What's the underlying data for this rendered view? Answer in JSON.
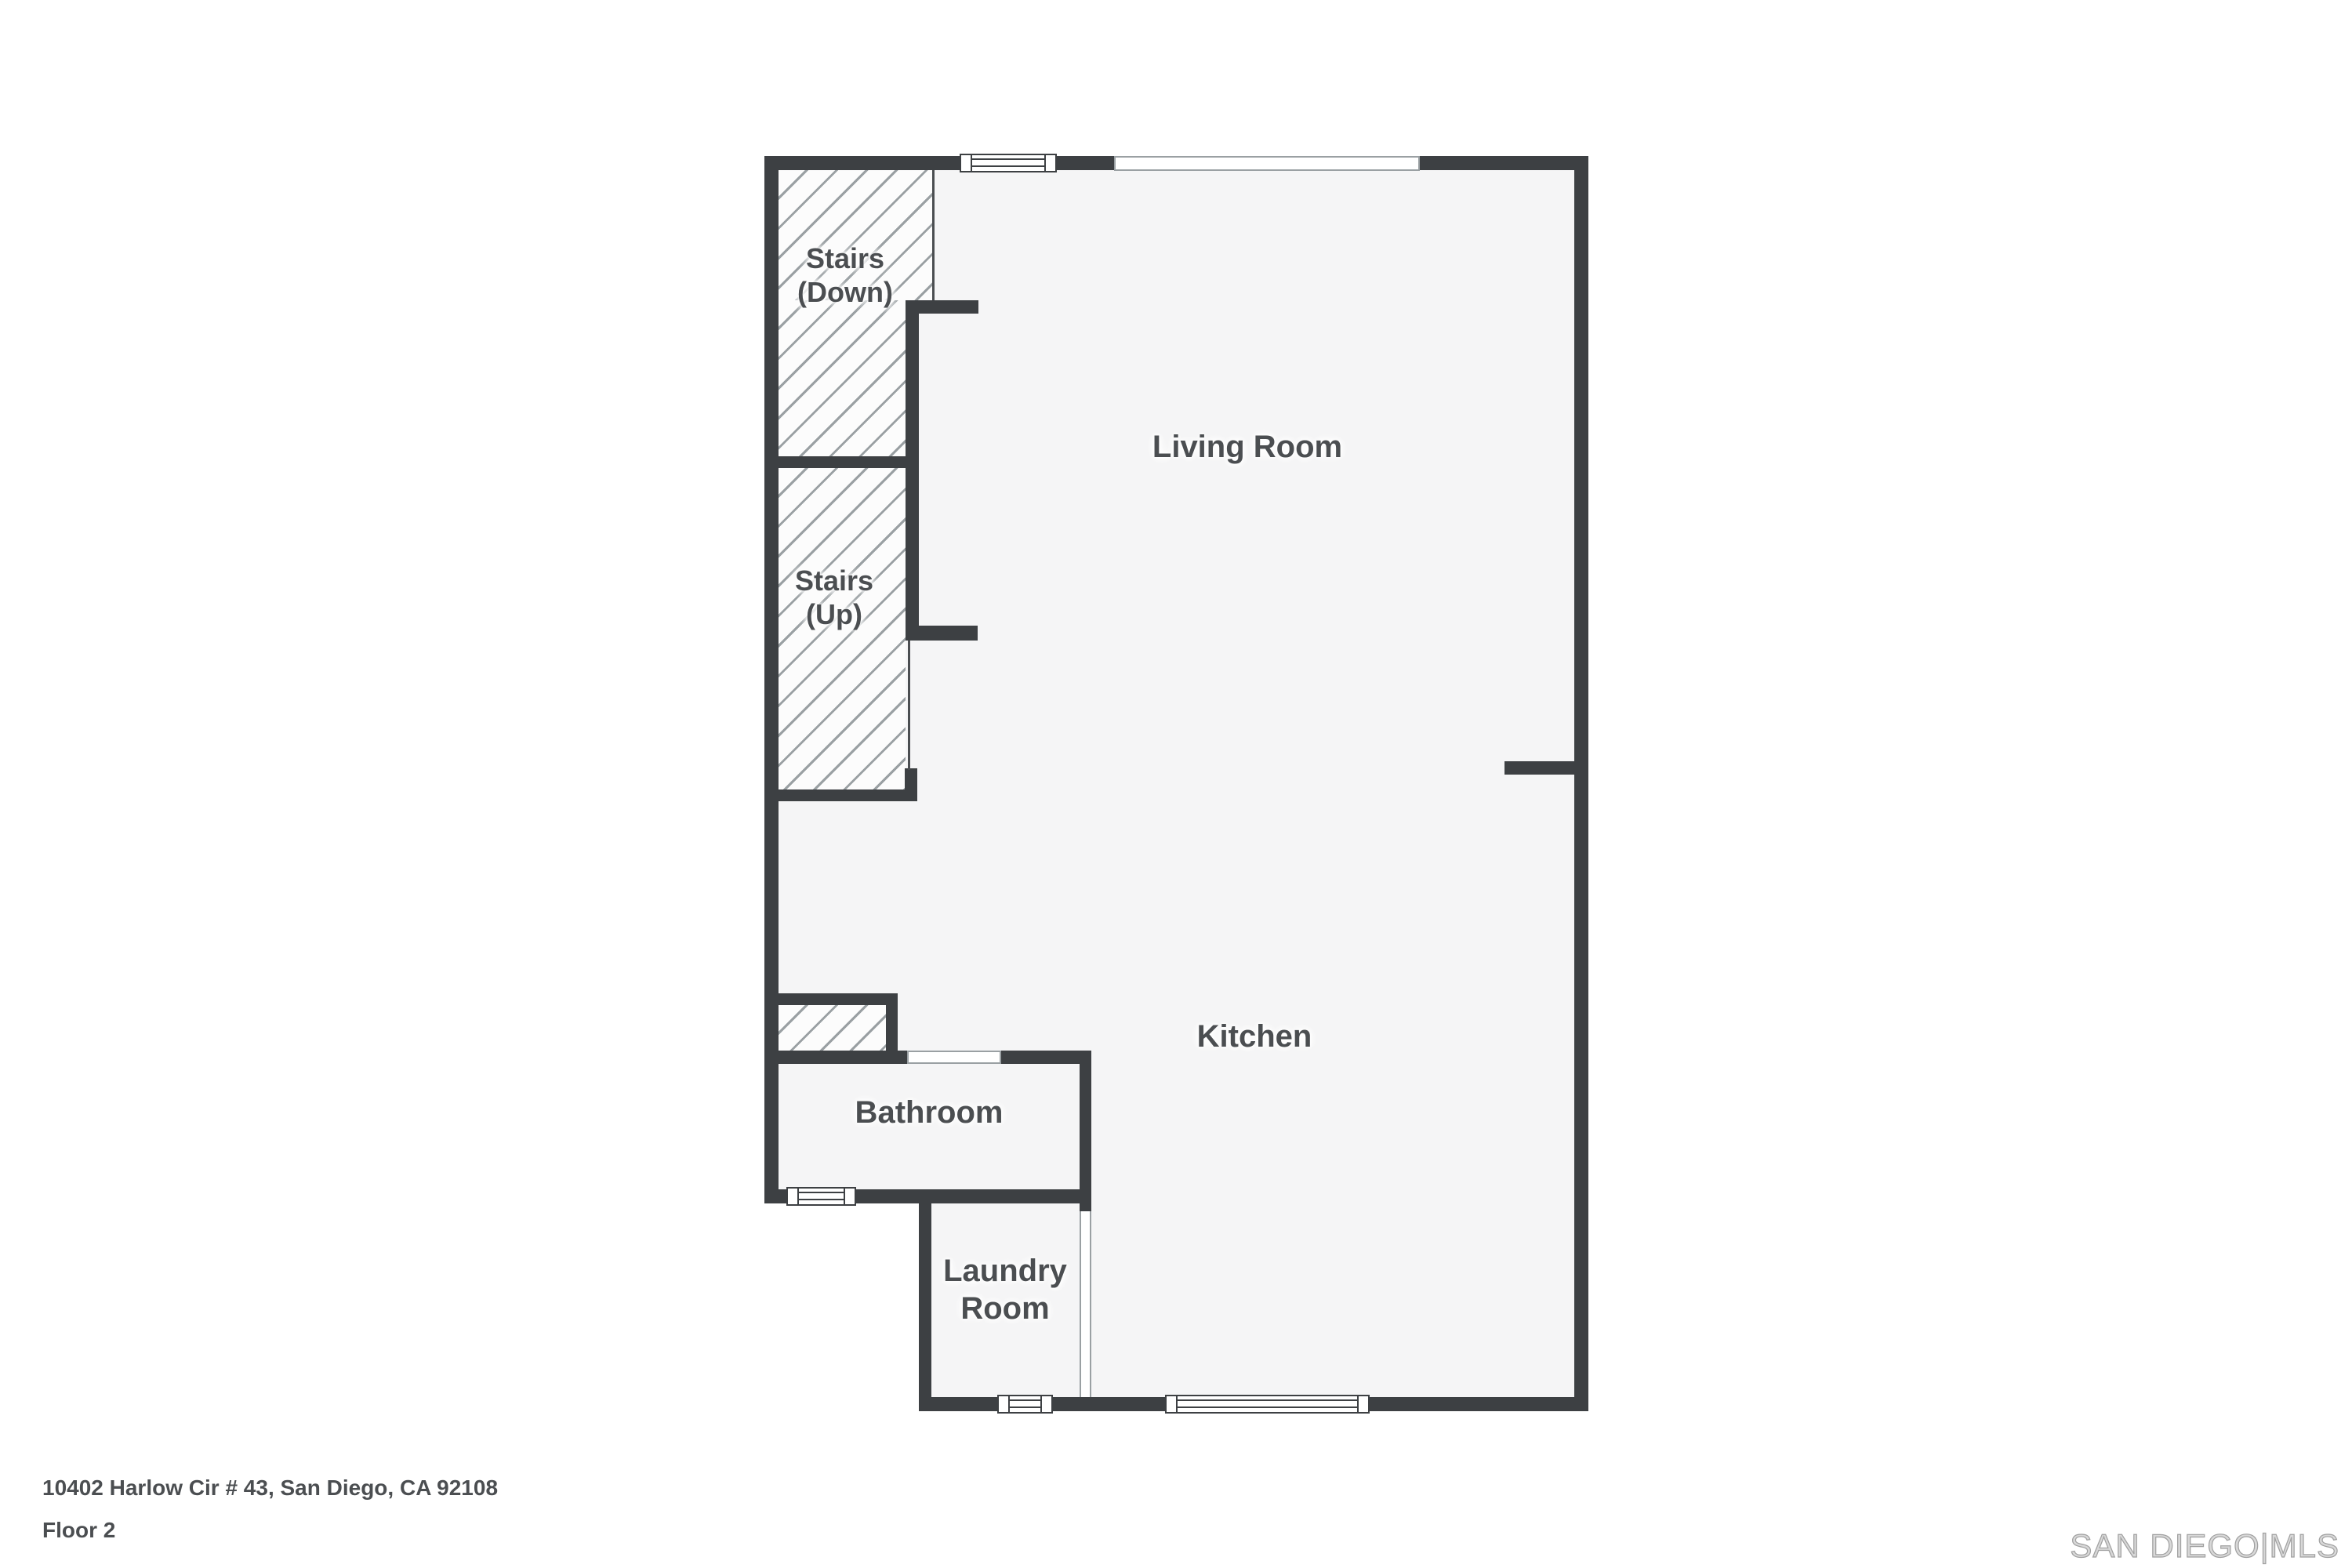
{
  "colors": {
    "wall": "#3d4043",
    "floor": "#f5f5f6",
    "hatch_bg": "#fcfcfc",
    "hatch_line": "#9aa0a3",
    "text": "#4b4e51",
    "thin": "#4b4e51",
    "win_border": "#3d4043",
    "win_border_light": "#9aa0a3",
    "watermark_fill": "#d8d8d8",
    "watermark_stroke": "#a0a0a0"
  },
  "rooms": [
    {
      "id": "stairs-down",
      "label": "Stairs\n(Down)"
    },
    {
      "id": "stairs-up",
      "label": "Stairs\n(Up)"
    },
    {
      "id": "living-room",
      "label": "Living Room"
    },
    {
      "id": "kitchen",
      "label": "Kitchen"
    },
    {
      "id": "bathroom",
      "label": "Bathroom"
    },
    {
      "id": "laundry-room",
      "label": "Laundry\nRoom"
    }
  ],
  "footer": {
    "address": "10402 Harlow Cir # 43, San Diego, CA 92108",
    "floor": "Floor 2"
  },
  "watermark": {
    "text": "SAN DIEGO|MLS"
  }
}
